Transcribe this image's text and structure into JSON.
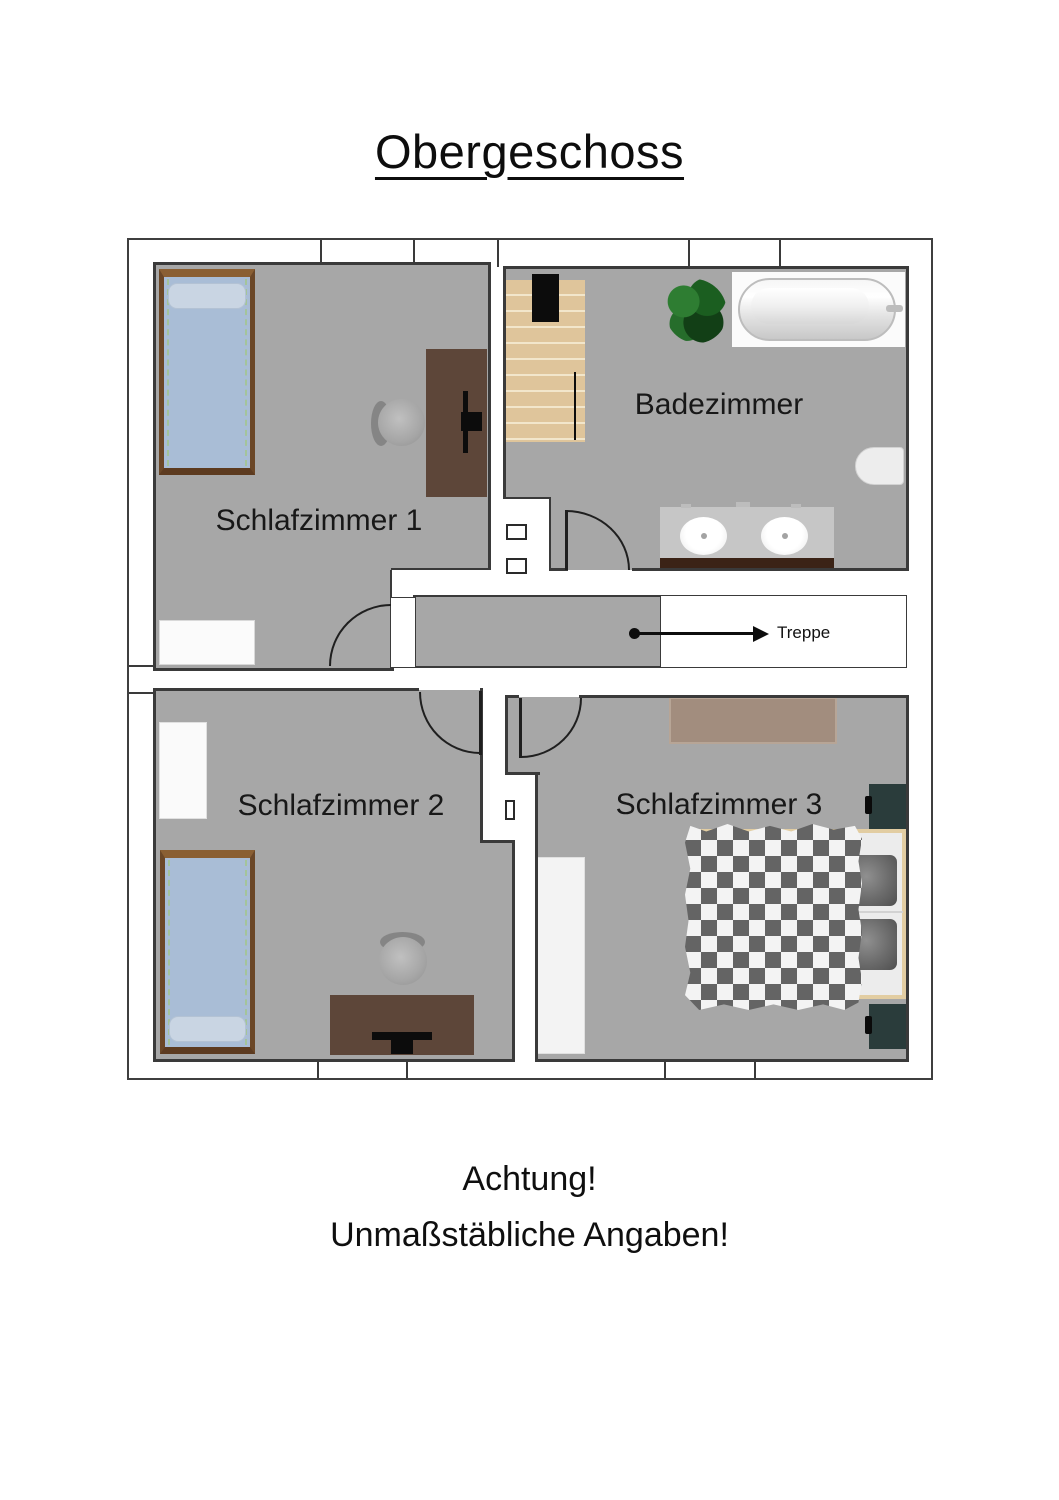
{
  "title": "Obergeschoss",
  "plan": {
    "rooms": [
      {
        "id": "schlafzimmer1",
        "label": "Schlafzimmer 1"
      },
      {
        "id": "badezimmer",
        "label": "Badezimmer"
      },
      {
        "id": "schlafzimmer2",
        "label": "Schlafzimmer 2"
      },
      {
        "id": "schlafzimmer3",
        "label": "Schlafzimmer 3"
      }
    ],
    "stairs_label": "Treppe",
    "furniture": [
      "single-bed",
      "desk",
      "office-chair",
      "cabinet",
      "stairs",
      "plant",
      "bathtub",
      "toilet",
      "double-washbasin",
      "wardrobe",
      "dresser",
      "double-bed",
      "nightstand"
    ]
  },
  "footer": {
    "line1": "Achtung!",
    "line2": "Unmaßstäbliche Angaben!"
  },
  "colors": {
    "floor": "#a7a7a7",
    "wall": "#3a3a3a",
    "bed_blue": "#a9bdd6",
    "bed_frame_brown": "#6b4727",
    "desk_brown": "#5d4639",
    "stairs_wood": "#dfc59b",
    "plant_green": "#1e6423",
    "vanity_edge_brown": "#3b2316",
    "nightstand_teal": "#2a3c3b",
    "dresser_tan": "#a28d7e",
    "duvet_grey": "#646464"
  }
}
